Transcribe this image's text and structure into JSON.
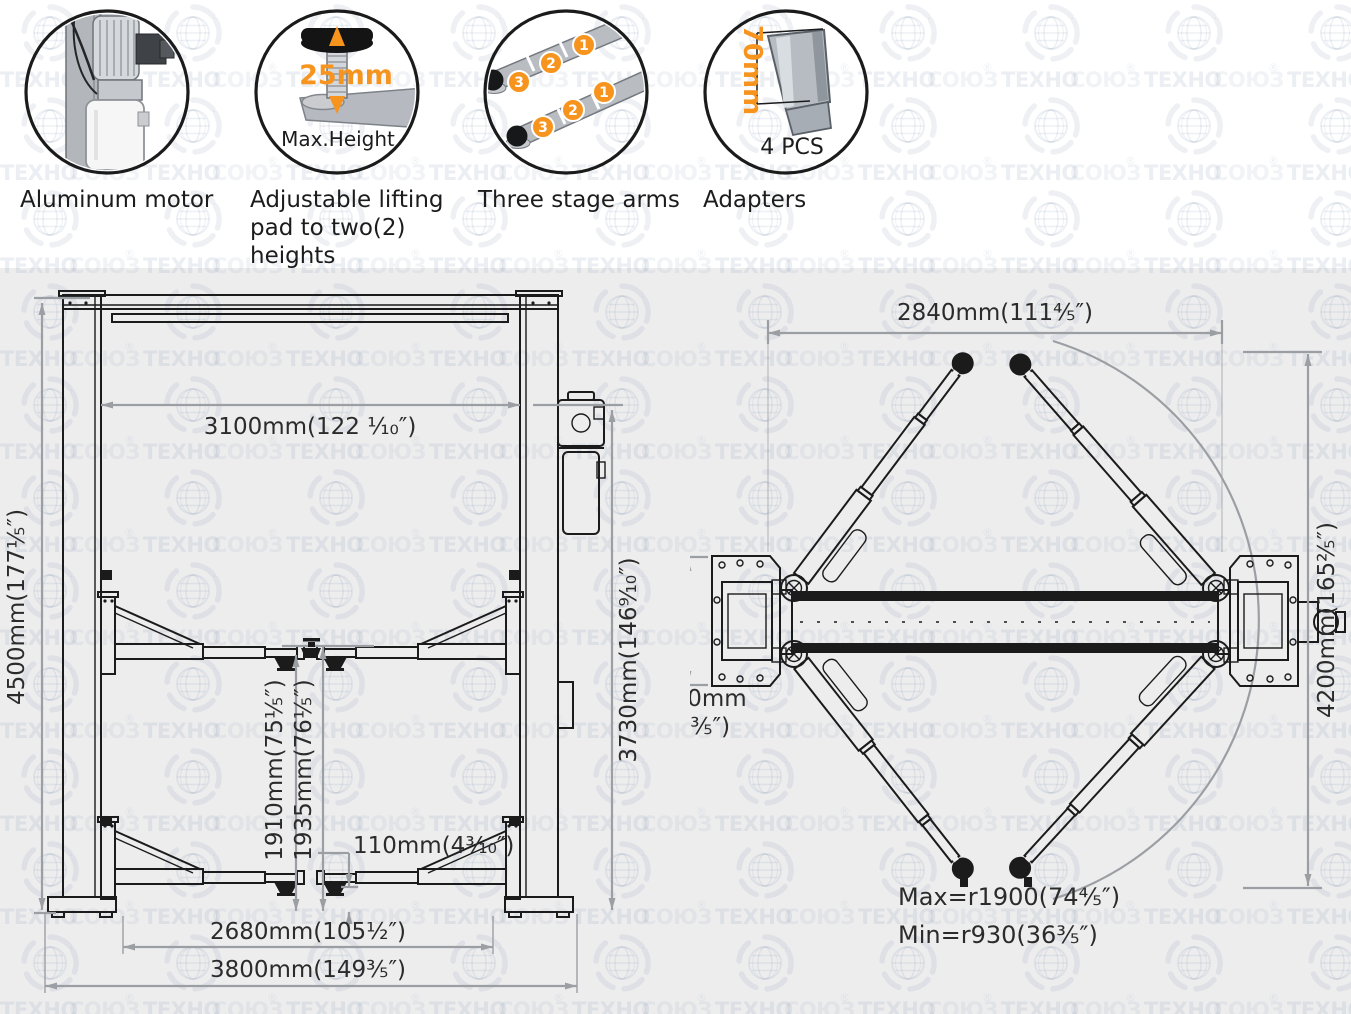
{
  "colors": {
    "accent": "#F7941E",
    "line": "#1b1b1b",
    "dimension": "#9b9fa3",
    "panel": "#ededee",
    "watermark": "#7589a8"
  },
  "watermark": {
    "brand_a": "ТЕХНО",
    "brand_b": "СОЮЗ",
    "reg": "®"
  },
  "features": [
    {
      "label": "Aluminum motor"
    },
    {
      "label_line1": "Adjustable lifting",
      "label_line2": "pad to two(2)",
      "label_line3": "heights",
      "value": "25mm",
      "caption": "Max.Height"
    },
    {
      "label": "Three stage arms",
      "s1": "1",
      "s2": "2",
      "s3": "3"
    },
    {
      "label": "Adapters",
      "value": "70mm",
      "caption": "4 PCS"
    }
  ],
  "front_view": {
    "height": "4500mm(177⅕″)",
    "clear_width": "3100mm(122 ⅒″)",
    "column_height": "3730mm(146⁹⁄₁₀″)",
    "arm_height": "1910mm(75⅕″)",
    "pad_height": "1935mm(76⅕″)",
    "pad_min": "110mm(4³⁄₁₀″)",
    "inner_width": "2680mm(105½″)",
    "overall_width": "3800mm(149⅗″)"
  },
  "top_view": {
    "inner_width": "2840mm(111⅘″)",
    "base_depth": "700mm",
    "base_depth_in": "(27⅗″)",
    "overall_length": "4200mm(165⅖″)",
    "reach_max": "Max=r1900(74⅘″)",
    "reach_min": "Min=r930(36⅗″)"
  }
}
